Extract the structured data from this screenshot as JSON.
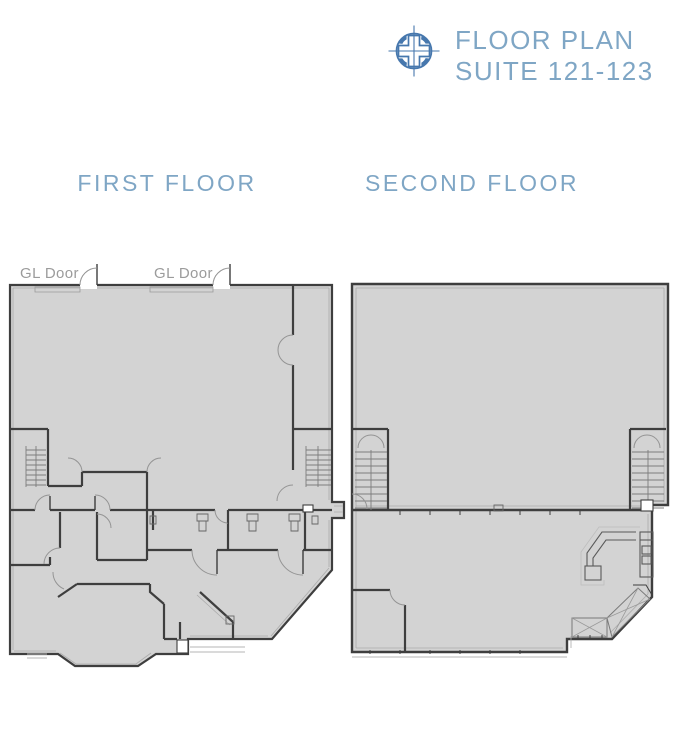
{
  "header": {
    "title_line1": "FLOOR PLAN",
    "title_line2": "SUITE 121-123",
    "logo_icon": "compass-cross-logo",
    "accent_color": "#4677ad",
    "text_color": "#7fa6c5"
  },
  "sections": {
    "first_floor": {
      "label": "FIRST FLOOR"
    },
    "second_floor": {
      "label": "SECOND FLOOR"
    }
  },
  "first_floor_plan": {
    "door_labels": [
      {
        "text": "GL Door"
      },
      {
        "text": "GL Door"
      }
    ]
  },
  "colors": {
    "background": "#ffffff",
    "plan_fill": "#d3d3d3",
    "wall": "#3e3e3e",
    "light_line": "#ababab",
    "label_gray": "#9b9b9b"
  }
}
